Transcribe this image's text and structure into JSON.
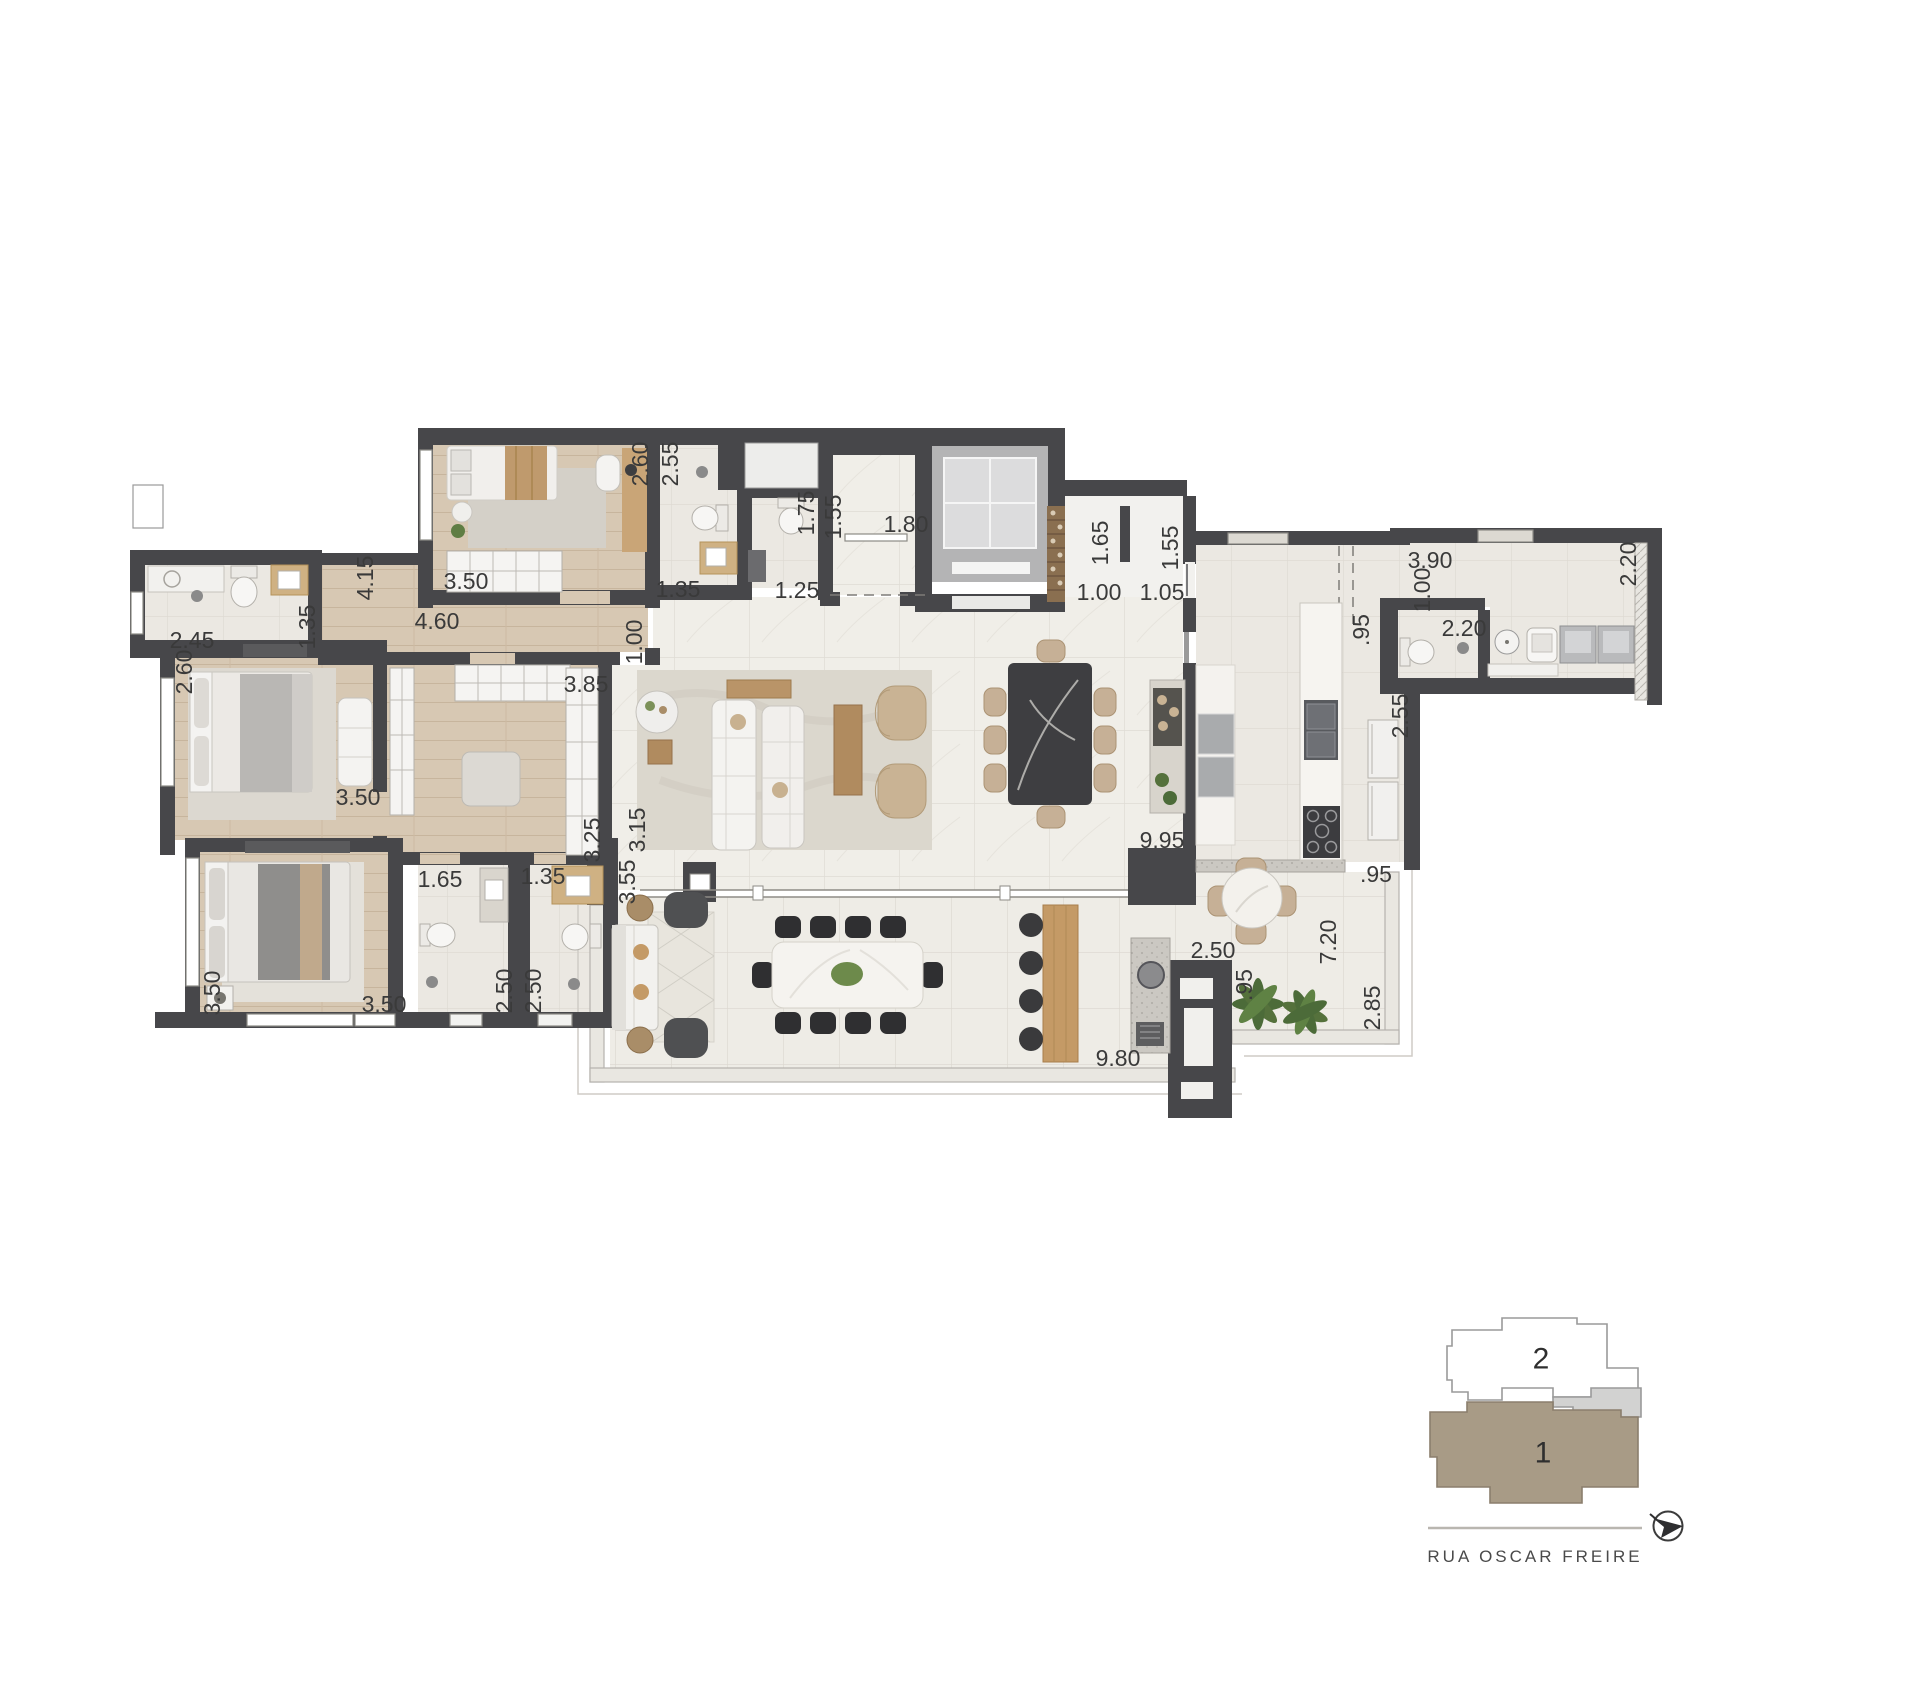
{
  "plan": {
    "type": "apartment-floor-plan",
    "dims": [
      "2.45",
      "1.35",
      "2.60",
      "4.15",
      "4.60",
      "3.50",
      "2.60",
      "2.55",
      "1.35",
      "1.75",
      "1.25",
      "1.55",
      "1.80",
      "1.65",
      "1.00",
      "1.55",
      "1.05",
      "3.90",
      "1.00",
      "2.20",
      "2.20",
      ".95",
      "2.55",
      ".95",
      "2.50",
      "7.20",
      ".95",
      "2.85",
      "9.80",
      "9.95",
      "1.00",
      "3.15",
      "3.55",
      "3.85",
      "3.25",
      "3.50",
      "1.65",
      "1.35",
      "2.50",
      "2.50",
      "3.50",
      "3.50"
    ]
  },
  "keyplan": {
    "unit_back_label": "2",
    "unit_front_label": "1",
    "street_name": "RUA OSCAR FREIRE"
  },
  "colors": {
    "wall": "#47474a",
    "wood_floor": "#d7c8b3",
    "marble_floor": "#f0eee8",
    "tile_floor": "#ebe8e2",
    "terrace_floor": "#eeece6",
    "keyplan_unit_fill": "#a89b86",
    "keyplan_annex_fill": "#d2d2d1",
    "plant_green": "#55713c",
    "label_text": "#3a3a3a"
  }
}
